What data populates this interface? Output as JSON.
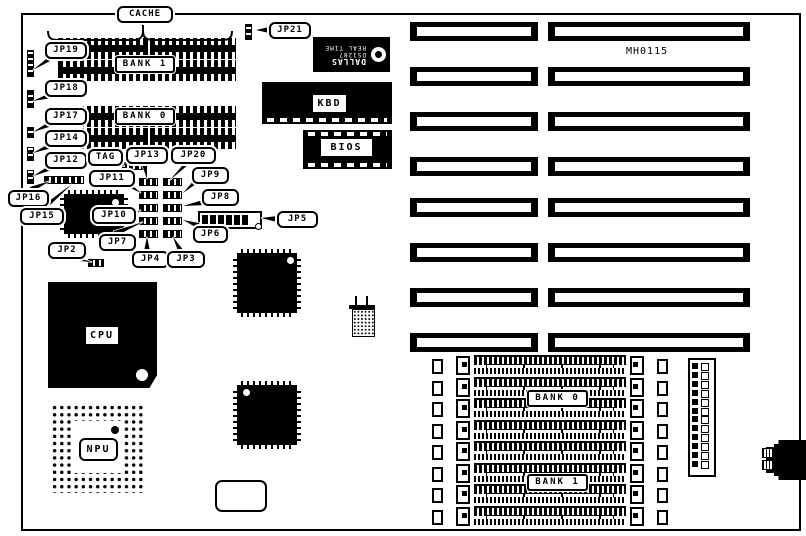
{
  "board": {
    "id_text": "MH0115",
    "colors": {
      "ink": "#000000",
      "paper": "#ffffff"
    }
  },
  "labels": {
    "cache": "CACHE",
    "cache_bank1": "BANK 1",
    "cache_bank0": "BANK 0",
    "simm_bank0": "BANK 0",
    "simm_bank1": "BANK 1",
    "cpu": "CPU",
    "npu": "NPU",
    "kbd": "KBD",
    "bios": "BIOS",
    "board_id": "MH0115",
    "dallas_line1": "DALLAS",
    "dallas_line2": "DS1287",
    "dallas_line3": "REAL TIME",
    "tag": "TAG",
    "jp2": "JP2",
    "jp3": "JP3",
    "jp4": "JP4",
    "jp5": "JP5",
    "jp6": "JP6",
    "jp7": "JP7",
    "jp8": "JP8",
    "jp9": "JP9",
    "jp10": "JP10",
    "jp11": "JP11",
    "jp12": "JP12",
    "jp13": "JP13",
    "jp14": "JP14",
    "jp15": "JP15",
    "jp16": "JP16",
    "jp17": "JP17",
    "jp18": "JP18",
    "jp19": "JP19",
    "jp20": "JP20",
    "jp21": "JP21"
  },
  "components": {
    "expansion_slot_rows": 8,
    "simm_socket_rows": 8,
    "cache_chip_rows": 4,
    "power_connector_pins": 12
  }
}
